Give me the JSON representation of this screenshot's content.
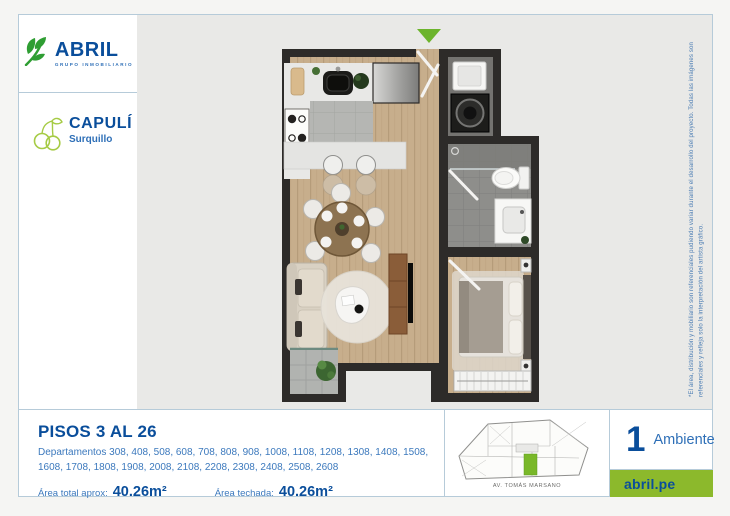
{
  "brand": {
    "name": "ABRIL",
    "tagline": "GRUPO INMOBILIARIO"
  },
  "project": {
    "name": "CAPULÍ",
    "district": "Surquillo"
  },
  "plan": {
    "entry_arrow_color": "#6cb42c",
    "wall_color": "#2d2b29",
    "wood_floor_color": "#c7ae8c"
  },
  "disclaimer": "*El área, distribución y mobiliario son referenciales pudiendo variar durante el desarrollo del proyecto. Todas las imágenes son referenciales y refleja solo la interpretación del artista gráfico.",
  "info": {
    "floors_title": "PISOS 3 AL 26",
    "departamentos": "Departamentos 308, 408, 508, 608, 708, 808, 908, 1008, 1108, 1208, 1308, 1408, 1508, 1608, 1708, 1808, 1908, 2008, 2108, 2208, 2308, 2408, 2508, 2608",
    "area_total_label": "Área total aprox:",
    "area_total_value": "40.26m²",
    "area_techada_label": "Área techada:",
    "area_techada_value": "40.26m²"
  },
  "keyplan": {
    "street": "AV. TOMÁS MARSANO",
    "highlight_color": "#79b829"
  },
  "unit": {
    "rooms_count": "1",
    "rooms_label": "Ambiente"
  },
  "footer": {
    "website": "abril.pe",
    "bg_color": "#8cb92c"
  },
  "colors": {
    "primary_blue": "#0a4e9b",
    "secondary_blue": "#2e6fb7",
    "accent_green": "#8cb92c",
    "panel_border": "#b6cbd9",
    "plan_background": "#e9e9e7",
    "page_background": "#f5f5f3"
  }
}
